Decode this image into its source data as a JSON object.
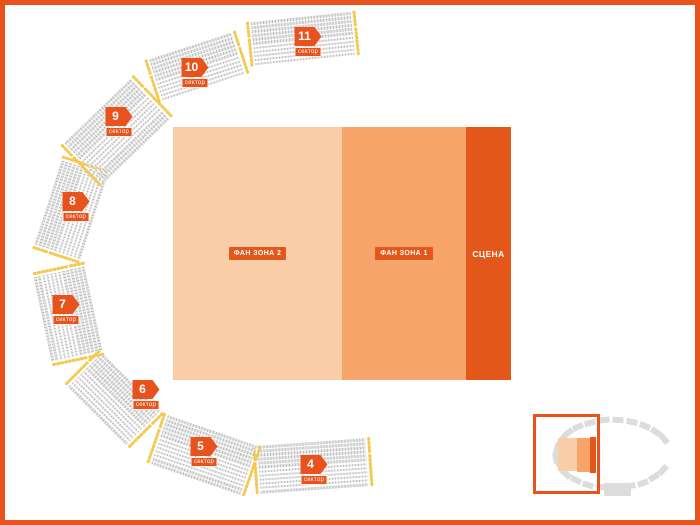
{
  "zones": {
    "fan_zone_2": "ФАН ЗОНА 2",
    "fan_zone_1": "ФАН ЗОНА 1",
    "stage": "СЦЕНА"
  },
  "sectors": [
    {
      "number": "4",
      "label": "сектор"
    },
    {
      "number": "5",
      "label": "сектор"
    },
    {
      "number": "6",
      "label": "сектор"
    },
    {
      "number": "7",
      "label": "сектор"
    },
    {
      "number": "8",
      "label": "сектор"
    },
    {
      "number": "9",
      "label": "сектор"
    },
    {
      "number": "10",
      "label": "сектор"
    },
    {
      "number": "11",
      "label": "сектор"
    }
  ],
  "colors": {
    "accent": "#E8521C",
    "stage": "#E3571B",
    "fan_zone_2": "#F9CDA8",
    "fan_zone_1": "#F6A469",
    "seat_gray": "#BCBCBC",
    "seat_yellow": "#F5C84F",
    "minimap_gray": "#DCDCDC"
  }
}
